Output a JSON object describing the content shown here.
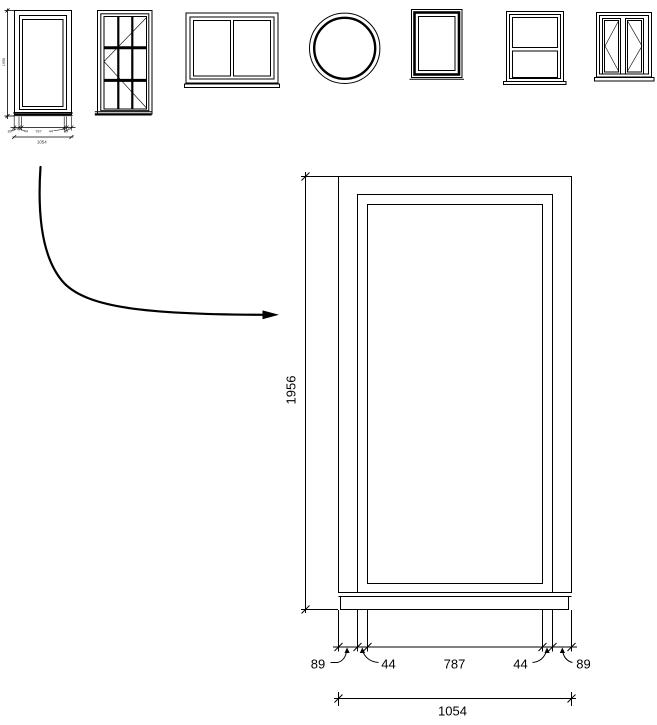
{
  "drawing": {
    "background_color": "#ffffff",
    "line_color": "#000000"
  },
  "window_type_thumbnails": {
    "items": [
      {
        "name": "fixed-window-with-dimensions"
      },
      {
        "name": "grid-casement-window"
      },
      {
        "name": "double-pane-slider-window"
      },
      {
        "name": "round-window"
      },
      {
        "name": "fixed-picture-window"
      },
      {
        "name": "double-hung-window"
      },
      {
        "name": "double-casement-window"
      }
    ]
  },
  "detail_view": {
    "height": "1956",
    "width_segments": [
      "89",
      "44",
      "787",
      "44",
      "89"
    ],
    "total_width": "1054"
  },
  "thumbnail_detail": {
    "height": "1956",
    "width_segments": [
      "89",
      "44",
      "787",
      "44",
      "89"
    ],
    "total_width": "1054"
  }
}
